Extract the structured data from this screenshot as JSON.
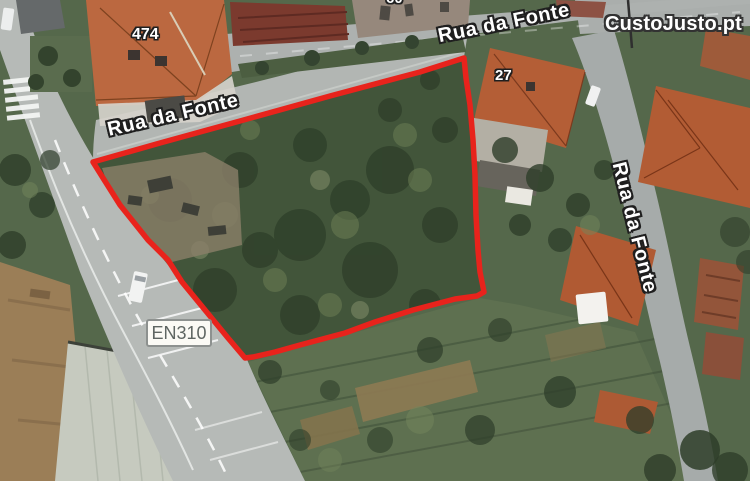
{
  "source": {
    "watermark": "CustoJusto.pt"
  },
  "map": {
    "view": "satellite",
    "road_labels": [
      {
        "id": "rua-da-fonte-top",
        "text": "Rua da Fonte"
      },
      {
        "id": "rua-da-fonte-west",
        "text": "Rua da Fonte"
      },
      {
        "id": "rua-da-fonte-east",
        "text": "Rua da Fonte"
      }
    ],
    "route_badge": {
      "text": "EN310"
    },
    "house_numbers": [
      {
        "id": "474",
        "text": "474"
      },
      {
        "id": "27",
        "text": "27"
      },
      {
        "id": "60",
        "text": "60"
      }
    ],
    "plot_outline": {
      "color": "#e8231c",
      "points": "93,162 160,143 240,121 330,96 420,72 464,58 466,78 470,105 473,140 475,175 476,215 478,250 480,272 484,292 477,296 455,299 413,310 375,322 345,333 300,345 275,352 253,357 245,358 228,338 205,310 182,282 168,260 148,240 120,205 103,178"
    }
  }
}
